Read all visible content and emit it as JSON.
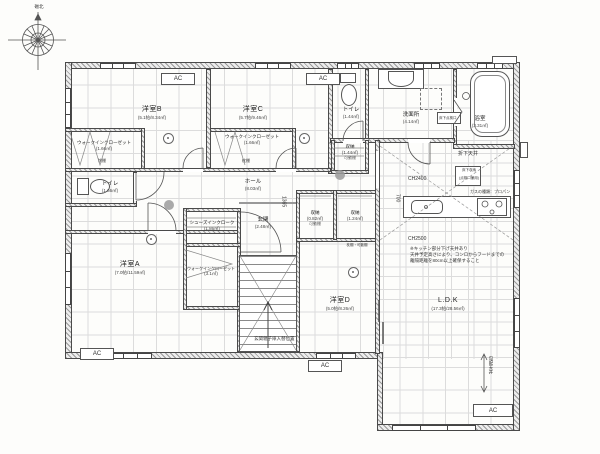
{
  "compass": {
    "label": "磁北"
  },
  "rooms": [
    {
      "name": "洋室B",
      "size": "(5.1帖/8.34㎡)"
    },
    {
      "name": "ウォークインクローゼット",
      "size": "(1.66㎡)"
    },
    {
      "name": "洋室C",
      "size": "(5.7帖/9.46㎡)"
    },
    {
      "name": "ウォークインクローゼット",
      "size": "(1.66㎡)"
    },
    {
      "name": "トイレ",
      "size": "(1.44㎡)"
    },
    {
      "name": "洗面所",
      "size": "(4.14㎡)"
    },
    {
      "name": "浴室",
      "size": "(3.31㎡)"
    },
    {
      "name": "収納",
      "size": "(1.44㎡)",
      "note": "可動棚"
    },
    {
      "name": "トイレ",
      "size": "(1.66㎡)"
    },
    {
      "name": "ホール",
      "size": "(8.03㎡)"
    },
    {
      "name": "玄関",
      "size": "(2.48㎡)"
    },
    {
      "name": "シューズインクローク",
      "size": "(1.86㎡)"
    },
    {
      "name": "収納",
      "size": "(0.82㎡)",
      "note": "可動棚"
    },
    {
      "name": "収納",
      "size": "(1.24㎡)",
      "note": "枕棚・可動棚"
    },
    {
      "name": "洋室A",
      "size": "(7.0帖/11.59㎡)"
    },
    {
      "name": "ウォークインクローゼット",
      "size": "(3.1㎡)"
    },
    {
      "name": "洋室D",
      "size": "(5.0帖/8.26㎡)"
    },
    {
      "name": "L.D.K",
      "size": "(17.3帖/28.56㎡)"
    }
  ],
  "labels": {
    "ac": "AC",
    "ch2400": "CH2400",
    "ch2500": "CH2500",
    "dim_700": "700",
    "dim_1365": "1365",
    "dropped_ceiling": "折下天井",
    "sloped_ceiling": "勾配天井",
    "gas_type": "ガスの種類：プロパン",
    "underfloor_storage": "床下収納",
    "underfloor_storage_sub": "(点検口兼用)",
    "floor_inspection": "床下点検口",
    "shelf": "枕棚",
    "porch_note": "玄関親子扉入替位置",
    "kitchen_note_1": "※キッチン部分下げ天井あり",
    "kitchen_note_2": "天井予定高さにより、コンロからフードまでの",
    "kitchen_note_3": "離隔距離を80cm以上確保すること"
  }
}
